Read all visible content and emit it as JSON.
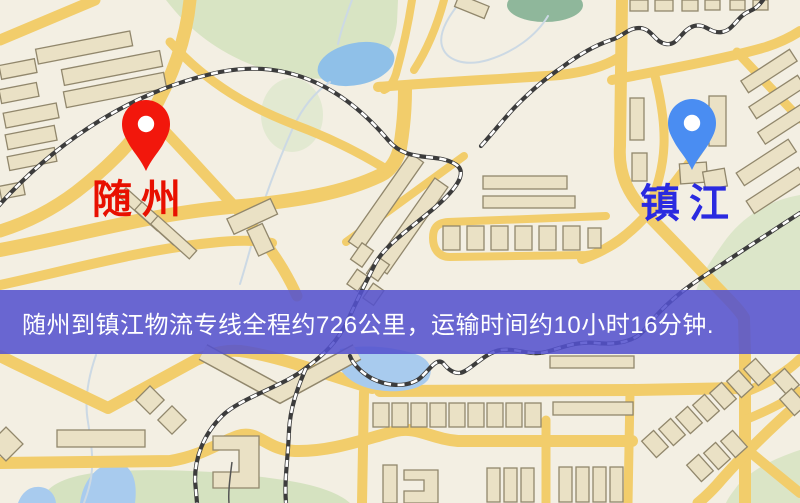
{
  "map": {
    "markers": [
      {
        "id": "origin",
        "label": "随州",
        "icon": "map-pin-icon",
        "pin_color": "#f2170c",
        "label_color": "#e81000"
      },
      {
        "id": "destination",
        "label": "镇江",
        "icon": "map-pin-icon",
        "pin_color": "#4a8df2",
        "label_color": "#2a2ae0"
      }
    ],
    "banner": {
      "text": "随州到镇江物流专线全程约726公里，运输时间约10小时16分钟.",
      "background": "#5452ce",
      "text_color": "#ffffff"
    },
    "route": {
      "distance": "726公里",
      "duration": "10小时16分钟"
    },
    "legend_colors": {
      "road": "#f2cd6b",
      "park": "#d8e4c3",
      "water": "#a8cbee",
      "building": "#eae1c5",
      "railway": "#3c3c3c"
    }
  }
}
